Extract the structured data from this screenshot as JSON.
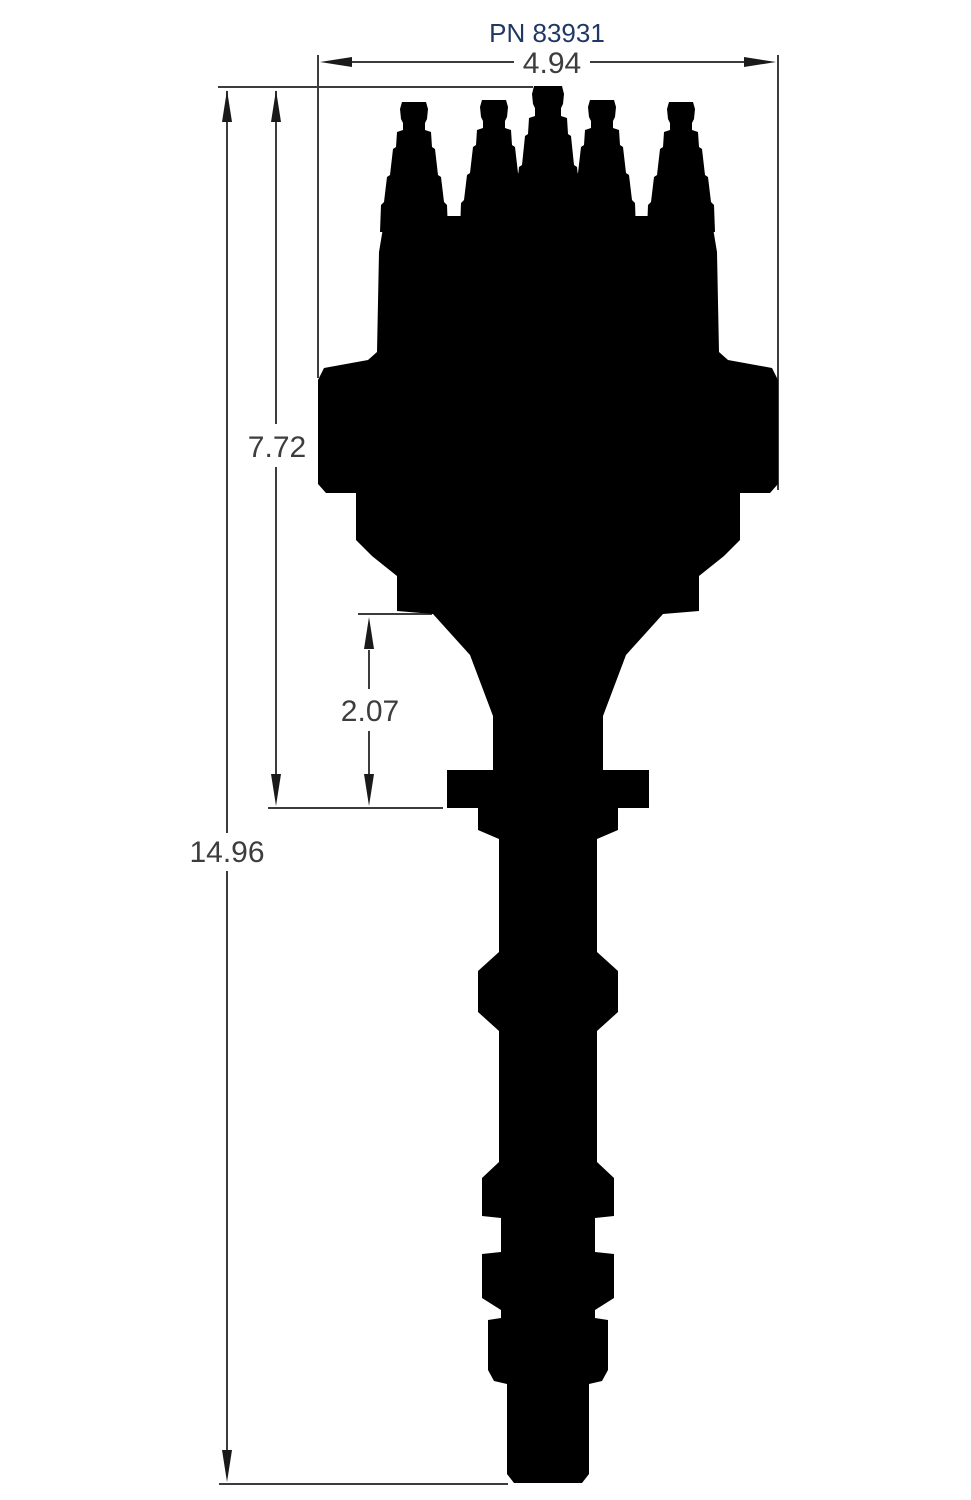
{
  "drawing": {
    "part_number": "PN 83931",
    "dimensions": {
      "cap_width": "4.94",
      "cap_to_flange_height": "7.72",
      "flange_to_housing": "2.07",
      "overall_height": "14.96"
    },
    "colors": {
      "silhouette": "#000000",
      "lines": "#3c3c3c",
      "arrows": "#1a1a1a",
      "dimension_text": "#3d3d3d",
      "part_number_text": "#1f3864",
      "background": "#ffffff"
    }
  }
}
